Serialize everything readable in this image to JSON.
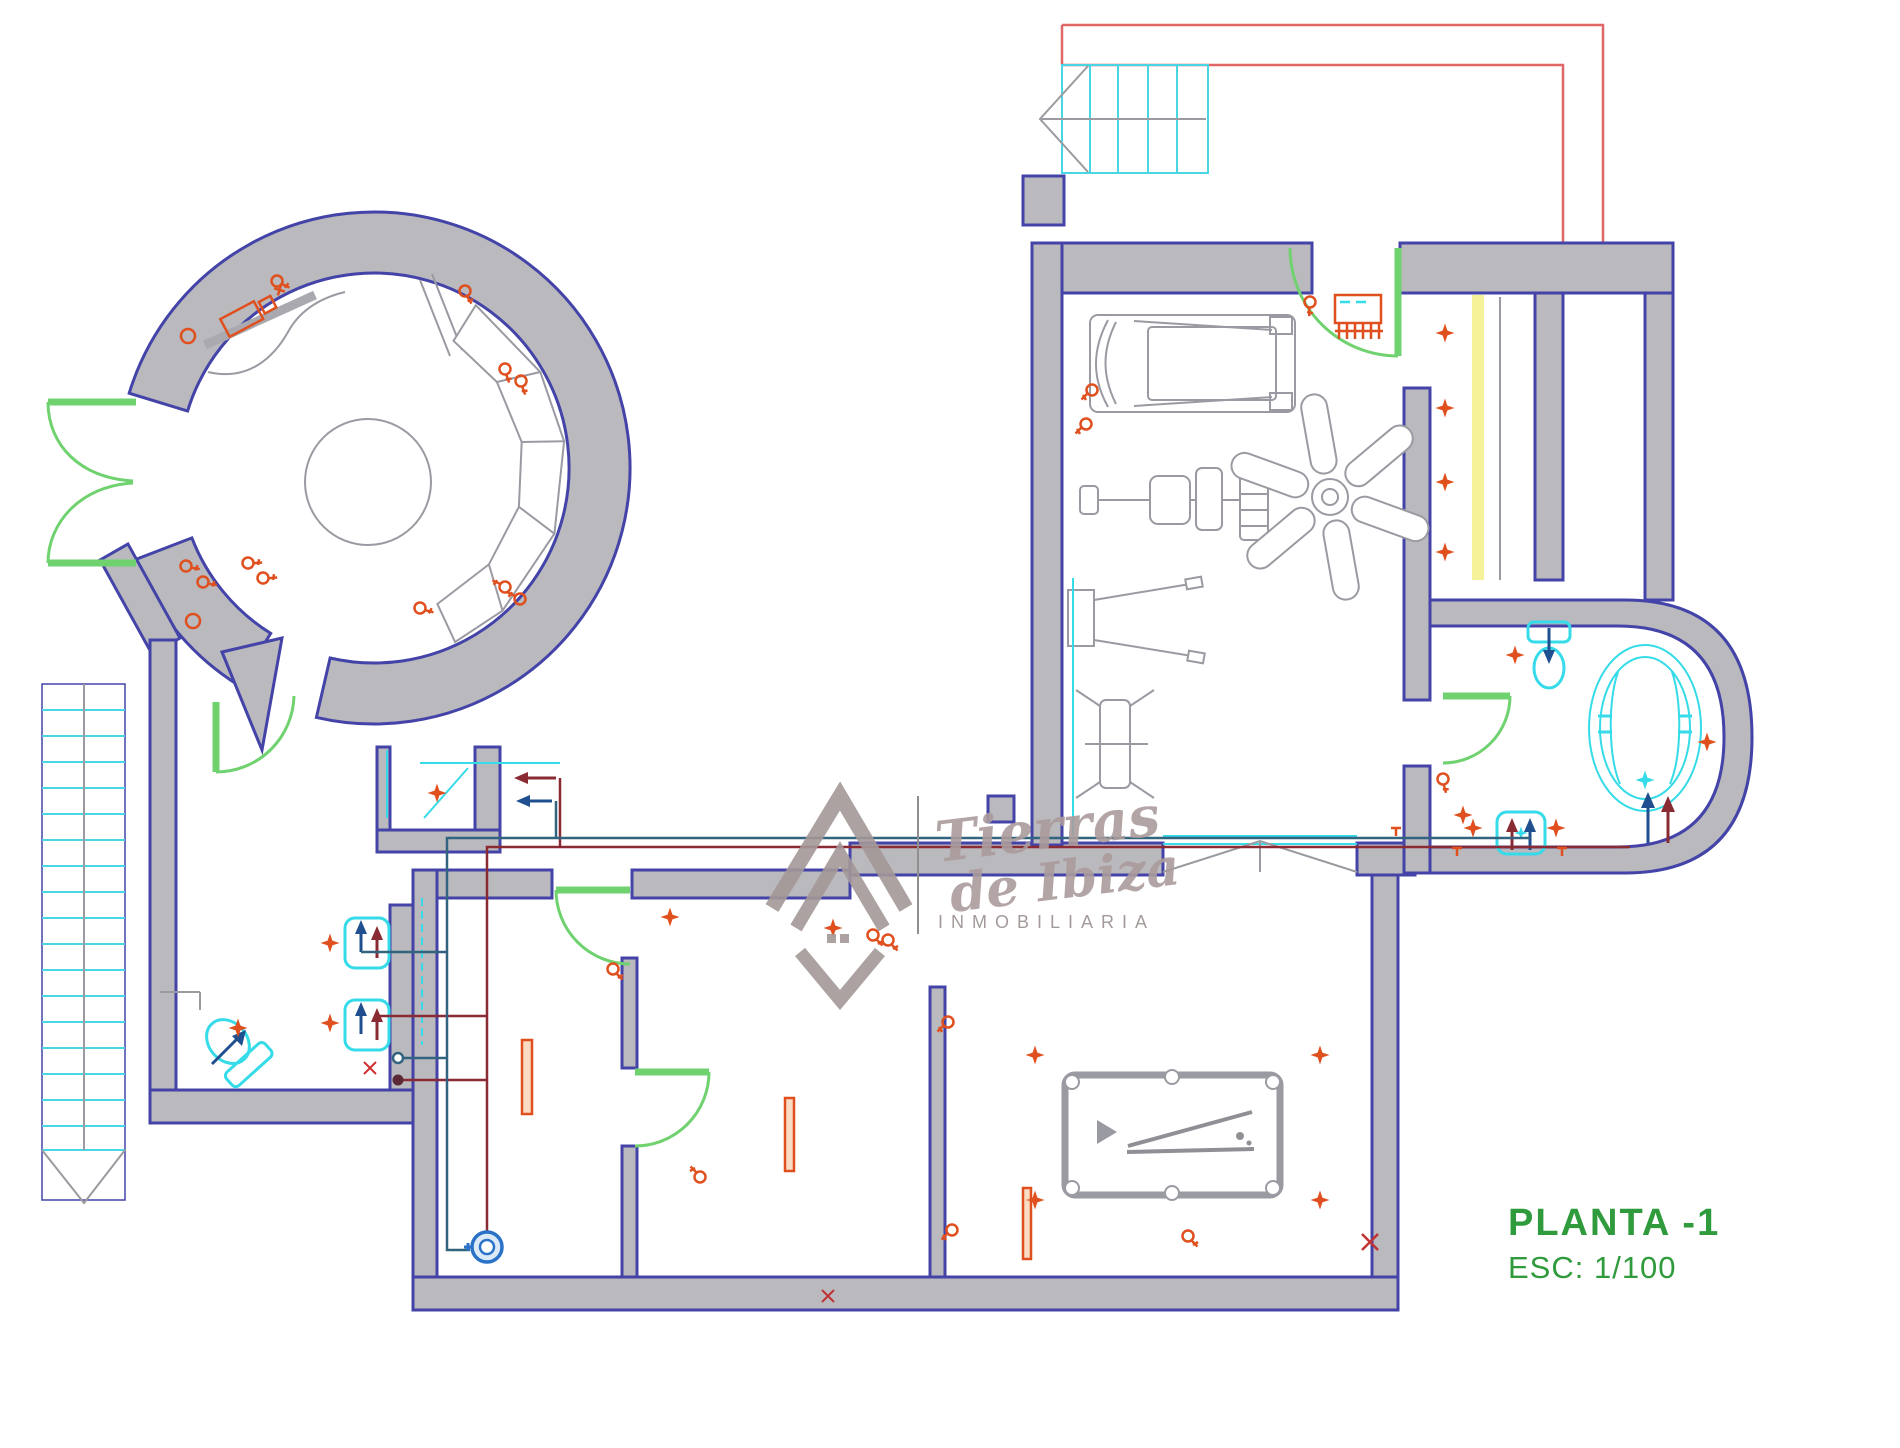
{
  "title_block": {
    "plan_label": "PLANTA -1",
    "scale_label": "ESC: 1/100"
  },
  "watermark": {
    "line1": "Tierras",
    "line2": "de Ibiza",
    "line3": "INMOBILIARIA"
  },
  "colors": {
    "wall_fill": "#b9b9be",
    "wall_stroke": "#4343a8",
    "door_green": "#6fd26f",
    "fixture_cyan": "#35dbe8",
    "electric_orange": "#e0501e",
    "pipe_hot": "#8a2b33",
    "pipe_cold": "#33647f",
    "upper_red": "#e06767",
    "window_yellow": "#f6f29a",
    "furniture_gray": "#9a9aa2",
    "stair_cyan": "#49d6e4",
    "boiler_blue": "#2a72c8",
    "text_green": "#2f9b3c",
    "watermark_gray": "#a89b9b",
    "arrow_blue": "#1f4f8f",
    "arrow_red": "#a02020"
  },
  "icons": {
    "outlet-icon": "small circle with angled stem (power outlet / switch)",
    "ceiling-light-icon": "four-point orange diamond star",
    "radiator-icon": "orange bar / comb panel (heater)",
    "boiler-icon": "double blue circle with pipe connections",
    "door-swing-icon": "green quarter-arc with leaf",
    "stair-icon": "cyan treads with gray direction line",
    "hot-water-arrow-icon": "dark red arrow",
    "cold-water-arrow-icon": "dark blue arrow",
    "house-logo-icon": "nested chevron house / diamond mark"
  }
}
